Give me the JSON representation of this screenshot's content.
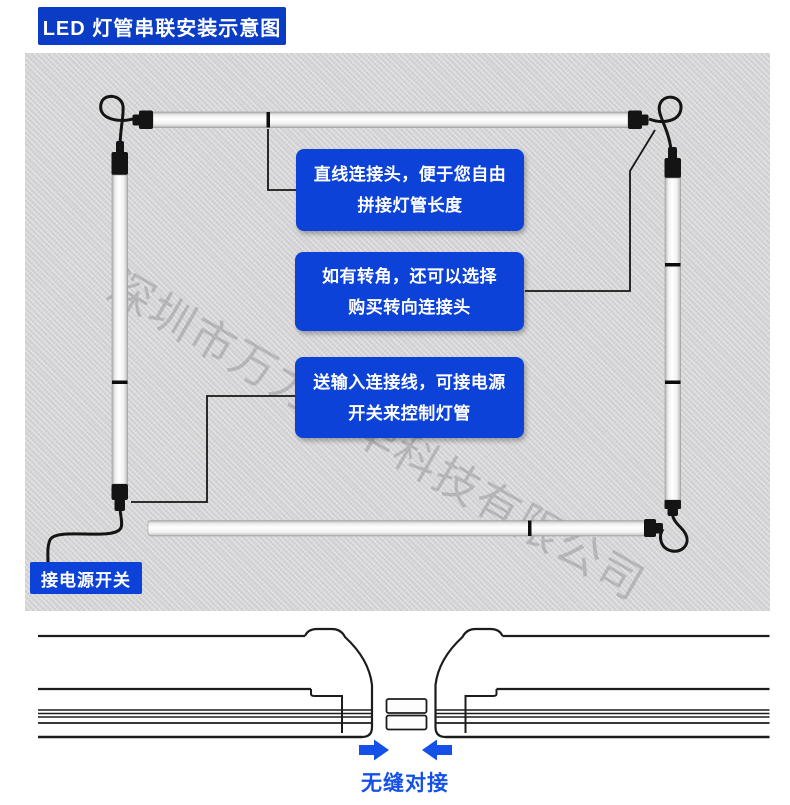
{
  "header": {
    "title": "LED 灯管串联安装示意图"
  },
  "watermark": "深圳市万力凡华科技有限公司",
  "callouts": [
    {
      "line1": "直线连接头，便于您自由",
      "line2": "拼接灯管长度"
    },
    {
      "line1": "如有转角，还可以选择",
      "line2": "购买转向连接头"
    },
    {
      "line1": "送输入连接线，可接电源",
      "line2": "开关来控制灯管"
    }
  ],
  "power_switch_label": "接电源开关",
  "seamless_label": "无缝对接",
  "colors": {
    "title_badge_blue": "#0a3cc6",
    "callout_blue": "#0c42d8",
    "accent_blue": "#1550e8",
    "panel_gray": "#d5d5d7",
    "tube_cap_black": "#141414"
  }
}
